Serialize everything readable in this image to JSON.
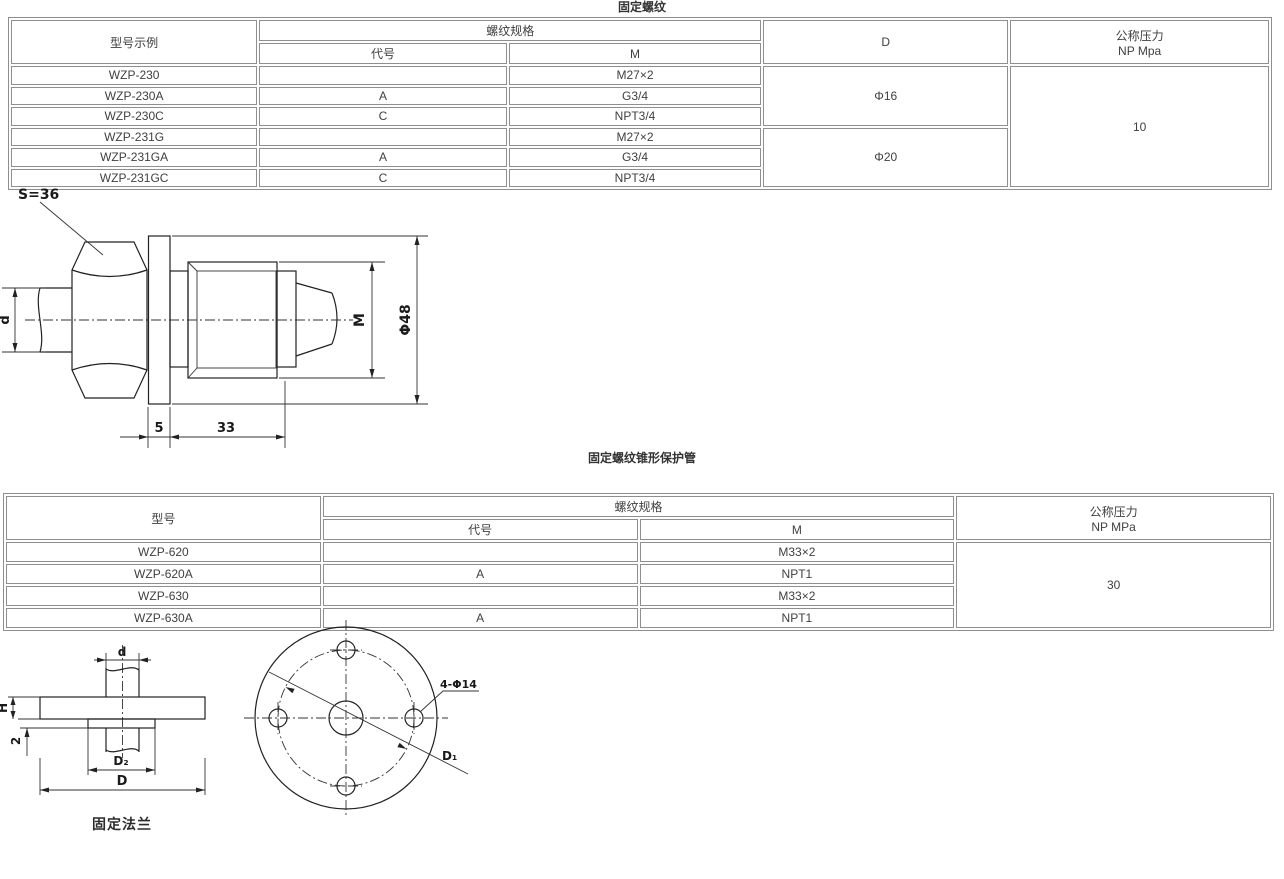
{
  "titles": {
    "section1": "固定螺纹",
    "section2": "固定螺纹锥形保护管"
  },
  "colors": {
    "table_border": "#8f8f8f",
    "table_text": "#3f3f3f",
    "drawing_line": "#222222"
  },
  "table1": {
    "headers": {
      "model": "型号示例",
      "thread_spec": "螺纹规格",
      "code": "代号",
      "metric": "M",
      "diameter": "D",
      "pressure_line1": "公称压力",
      "pressure_line2": "NP Mpa"
    },
    "rows": [
      {
        "model": "WZP-230",
        "code": "",
        "metric": "M27×2"
      },
      {
        "model": "WZP-230A",
        "code": "A",
        "metric": "G3/4"
      },
      {
        "model": "WZP-230C",
        "code": "C",
        "metric": "NPT3/4"
      },
      {
        "model": "WZP-231G",
        "code": "",
        "metric": "M27×2"
      },
      {
        "model": "WZP-231GA",
        "code": "A",
        "metric": "G3/4"
      },
      {
        "model": "WZP-231GC",
        "code": "C",
        "metric": "NPT3/4"
      }
    ],
    "diameter_groups": [
      {
        "value": "Φ16"
      },
      {
        "value": "Φ20"
      }
    ],
    "pressure_value": "10"
  },
  "table2": {
    "headers": {
      "model": "型号",
      "thread_spec": "螺纹规格",
      "code": "代号",
      "metric": "M",
      "pressure_line1": "公称压力",
      "pressure_line2": "NP MPa"
    },
    "rows": [
      {
        "model": "WZP-620",
        "code": "",
        "metric": "M33×2"
      },
      {
        "model": "WZP-620A",
        "code": "A",
        "metric": "NPT1"
      },
      {
        "model": "WZP-630",
        "code": "",
        "metric": "M33×2"
      },
      {
        "model": "WZP-630A",
        "code": "A",
        "metric": "NPT1"
      }
    ],
    "pressure_value": "30"
  },
  "drawing_fitting": {
    "wrench_size": "S=36",
    "tube_dia": "d",
    "thread_label": "M",
    "outer_dia": "Φ48",
    "flange_thickness": "5",
    "thread_length": "33"
  },
  "drawing_flange_side": {
    "tube_dia": "d",
    "height": "H",
    "boss_height": "2",
    "boss_dia": "D₂",
    "flange_dia": "D",
    "caption": "固定法兰"
  },
  "drawing_flange_front": {
    "bolt_holes": "4-Φ14",
    "bolt_circle": "D₁"
  }
}
